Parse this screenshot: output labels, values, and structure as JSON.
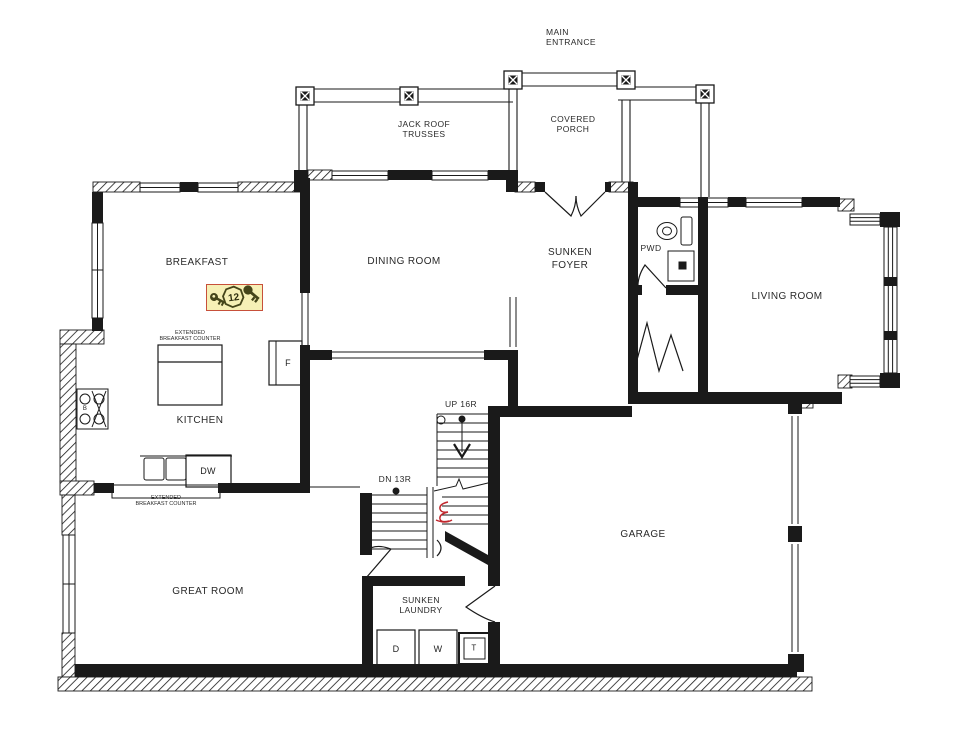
{
  "plan": {
    "labels": {
      "main_entrance": "MAIN\nENTRANCE",
      "jack_roof_trusses": "JACK ROOF\nTRUSSES",
      "covered_porch": "COVERED\nPORCH",
      "breakfast": "BREAKFAST",
      "dining_room": "DINING ROOM",
      "sunken_foyer": "SUNKEN\nFOYER",
      "pwd": "PWD",
      "living_room": "LIVING ROOM",
      "kitchen": "KITCHEN",
      "island_counter": "EXTENDED\nBREAKFAST COUNTER",
      "peninsula_counter": "EXTENDED\nBREAKFAST COUNTER",
      "up_stairs": "UP 16R",
      "down_stairs": "DN 13R",
      "garage": "GARAGE",
      "great_room": "GREAT ROOM",
      "sunken_laundry": "SUNKEN\nLAUNDRY"
    },
    "appliances": {
      "fridge": "F",
      "dishwasher": "DW",
      "burners": "B",
      "dryer": "D",
      "washer": "W",
      "tub": "T"
    },
    "marker": {
      "badge_value": "12",
      "icons": [
        "key-icon",
        "badge-12",
        "key-icon"
      ],
      "background": "#f6f0b6",
      "border": "#c7503a",
      "glyph_color": "#45451a"
    },
    "colors": {
      "line": "#1a1a1a",
      "background": "#ffffff",
      "annotation_red": "#c1272d"
    }
  }
}
